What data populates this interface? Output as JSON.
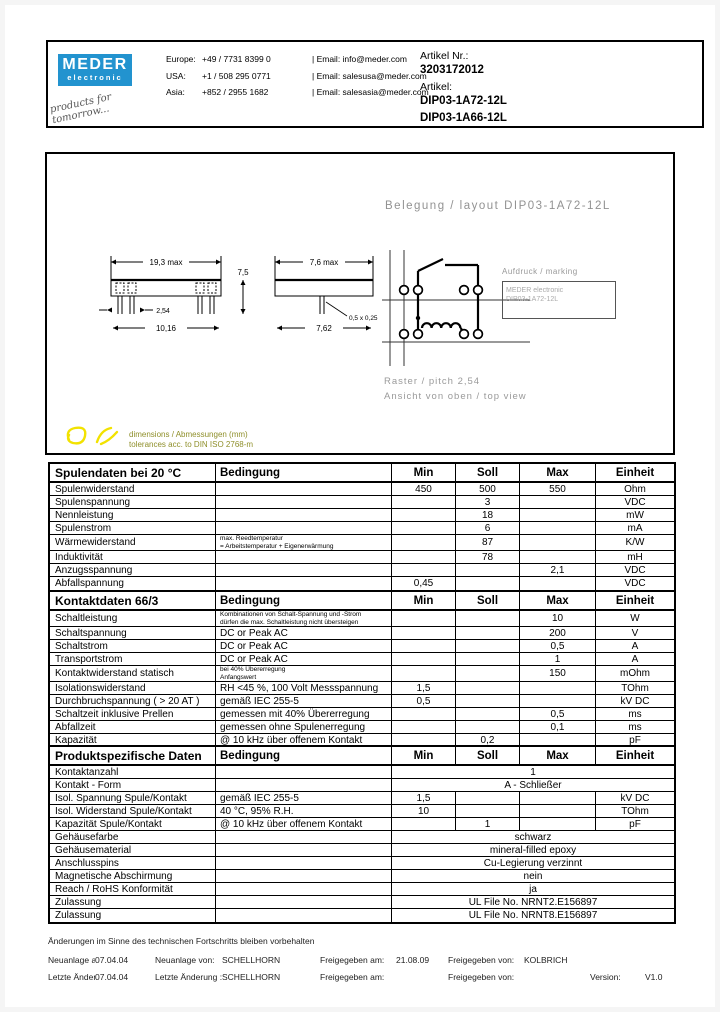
{
  "header": {
    "logo": {
      "brand": "MEDER",
      "sub": "electronic",
      "tagline": "products for tomorrow..."
    },
    "contacts": [
      {
        "region": "Europe:",
        "phone": "+49 / 7731 8399 0"
      },
      {
        "region": "USA:",
        "phone": "+1 / 508 295 0771"
      },
      {
        "region": "Asia:",
        "phone": "+852 / 2955 1682"
      }
    ],
    "emails": [
      "| Email: info@meder.com",
      "| Email: salesusa@meder.com",
      "| Email: salesasia@meder.com"
    ],
    "artikel_nr_label": "Artikel Nr.:",
    "artikel_nr": "3203172012",
    "artikel_label": "Artikel:",
    "artikel_items": [
      "DIP03-1A72-12L",
      "DIP03-1A66-12L"
    ]
  },
  "drawing": {
    "layout_title": "Belegung / layout DIP03-1A72-12L",
    "marking_label": "Aufdruck / marking",
    "marking_box_lines": [
      "MEDER electronic",
      "DIP03-1A72-12L"
    ],
    "pitch_note": "Raster / pitch 2,54",
    "view_note": "Ansicht von oben / top view",
    "dim_note_line1": "dimensions / Abmessungen (mm)",
    "dim_note_line2": "tolerances acc. to DIN ISO 2768-m",
    "dims": {
      "length": "19,3 max",
      "pin_span": "10,16",
      "pitch": "2,54",
      "height": "7,5",
      "width": "7,6 max",
      "row_spacing": "7,62",
      "pin_size": "0,5 x 0,25"
    }
  },
  "tables": [
    {
      "title": "Spulendaten bei 20 °C",
      "headers": {
        "condition": "Bedingung",
        "min": "Min",
        "soll": "Soll",
        "max": "Max",
        "unit": "Einheit"
      },
      "rows": [
        {
          "param": "Spulenwiderstand",
          "min": "450",
          "soll": "500",
          "max": "550",
          "unit": "Ohm"
        },
        {
          "param": "Spulenspannung",
          "soll": "3",
          "unit": "VDC"
        },
        {
          "param": "Nennleistung",
          "soll": "18",
          "unit": "mW"
        },
        {
          "param": "Spulenstrom",
          "soll": "6",
          "unit": "mA"
        },
        {
          "param": "Wärmewiderstand",
          "cond_small": [
            "max. Reedtemperatur",
            "= Arbeitstemperatur + Eigenerwärmung"
          ],
          "soll": "87",
          "unit": "K/W"
        },
        {
          "param": "Induktivität",
          "soll": "78",
          "unit": "mH"
        },
        {
          "param": "Anzugsspannung",
          "max": "2,1",
          "unit": "VDC"
        },
        {
          "param": "Abfallspannung",
          "min": "0,45",
          "unit": "VDC"
        }
      ]
    },
    {
      "title": "Kontaktdaten  66/3",
      "headers": {
        "condition": "Bedingung",
        "min": "Min",
        "soll": "Soll",
        "max": "Max",
        "unit": "Einheit"
      },
      "rows": [
        {
          "param": "Schaltleistung",
          "cond_small": [
            "Kombinationen von Schalt-Spannung und -Strom",
            "dürfen die max. Schaltleistung nicht übersteigen"
          ],
          "max": "10",
          "unit": "W"
        },
        {
          "param": "Schaltspannung",
          "cond": "DC or Peak AC",
          "max": "200",
          "unit": "V"
        },
        {
          "param": "Schaltstrom",
          "cond": "DC or Peak AC",
          "max": "0,5",
          "unit": "A"
        },
        {
          "param": "Transportstrom",
          "cond": "DC or Peak AC",
          "max": "1",
          "unit": "A"
        },
        {
          "param": "Kontaktwiderstand statisch",
          "cond_small": [
            "bei 40% Übererregung",
            "Anfangswert"
          ],
          "max": "150",
          "unit": "mOhm"
        },
        {
          "param": "Isolationswiderstand",
          "cond": "RH <45 %, 100 Volt Messspannung",
          "min": "1,5",
          "unit": "TOhm"
        },
        {
          "param": "Durchbruchspannung ( > 20 AT )",
          "cond": "gemäß  IEC 255-5",
          "min": "0,5",
          "unit": "kV DC"
        },
        {
          "param": "Schaltzeit inklusive Prellen",
          "cond": "gemessen mit 40% Übererregung",
          "max": "0,5",
          "unit": "ms"
        },
        {
          "param": "Abfallzeit",
          "cond": "gemessen ohne Spulenerregung",
          "max": "0,1",
          "unit": "ms"
        },
        {
          "param": "Kapazität",
          "cond": "@ 10 kHz über offenem Kontakt",
          "soll": "0,2",
          "unit": "pF"
        }
      ]
    },
    {
      "title": "Produktspezifische Daten",
      "headers": {
        "condition": "Bedingung",
        "min": "Min",
        "soll": "Soll",
        "max": "Max",
        "unit": "Einheit"
      },
      "rows": [
        {
          "param": "Kontaktanzahl",
          "span": "1"
        },
        {
          "param": "Kontakt - Form",
          "span": "A - Schließer"
        },
        {
          "param": "Isol. Spannung Spule/Kontakt",
          "cond": "gemäß  IEC 255-5",
          "min": "1,5",
          "unit": "kV DC"
        },
        {
          "param": "Isol. Widerstand Spule/Kontakt",
          "cond": "40 °C, 95% R.H.",
          "min": "10",
          "unit": "TOhm"
        },
        {
          "param": "Kapazität Spule/Kontakt",
          "cond": "@ 10 kHz über offenem Kontakt",
          "soll": "1",
          "unit": "pF"
        },
        {
          "param": "Gehäusefarbe",
          "span": "schwarz"
        },
        {
          "param": "Gehäusematerial",
          "span": "mineral-filled epoxy"
        },
        {
          "param": "Anschlusspins",
          "span": "Cu-Legierung verzinnt"
        },
        {
          "param": "Magnetische Abschirmung",
          "span": "nein"
        },
        {
          "param": "Reach / RoHS Konformität",
          "span": "ja"
        },
        {
          "param": "Zulassung",
          "span": "UL File No. NRNT2.E156897"
        },
        {
          "param": "Zulassung",
          "span": "UL File No. NRNT8.E156897"
        }
      ]
    }
  ],
  "footer": {
    "notice": "Änderungen im Sinne des technischen Fortschritts bleiben vorbehalten",
    "rows": [
      [
        {
          "label": "Neuanlage am:",
          "value": "07.04.04"
        },
        {
          "label": "Neuanlage von:",
          "value": "SCHELLHORN"
        },
        {
          "label": "Freigegeben am:",
          "value": "21.08.09"
        },
        {
          "label": "Freigegeben von:",
          "value": "KOLBRICH"
        },
        {
          "label": "",
          "value": ""
        }
      ],
      [
        {
          "label": "Letzte Änderung",
          "value": "07.04.04"
        },
        {
          "label": "Letzte Änderung :",
          "value": "SCHELLHORN"
        },
        {
          "label": "Freigegeben am:",
          "value": ""
        },
        {
          "label": "Freigegeben von:",
          "value": ""
        },
        {
          "label": "Version:",
          "value": "V1.0"
        }
      ]
    ]
  },
  "colors": {
    "brand_blue": "#2293cf",
    "marker_yellow": "#f2e200",
    "faint_gray": "#9a9a9a"
  }
}
